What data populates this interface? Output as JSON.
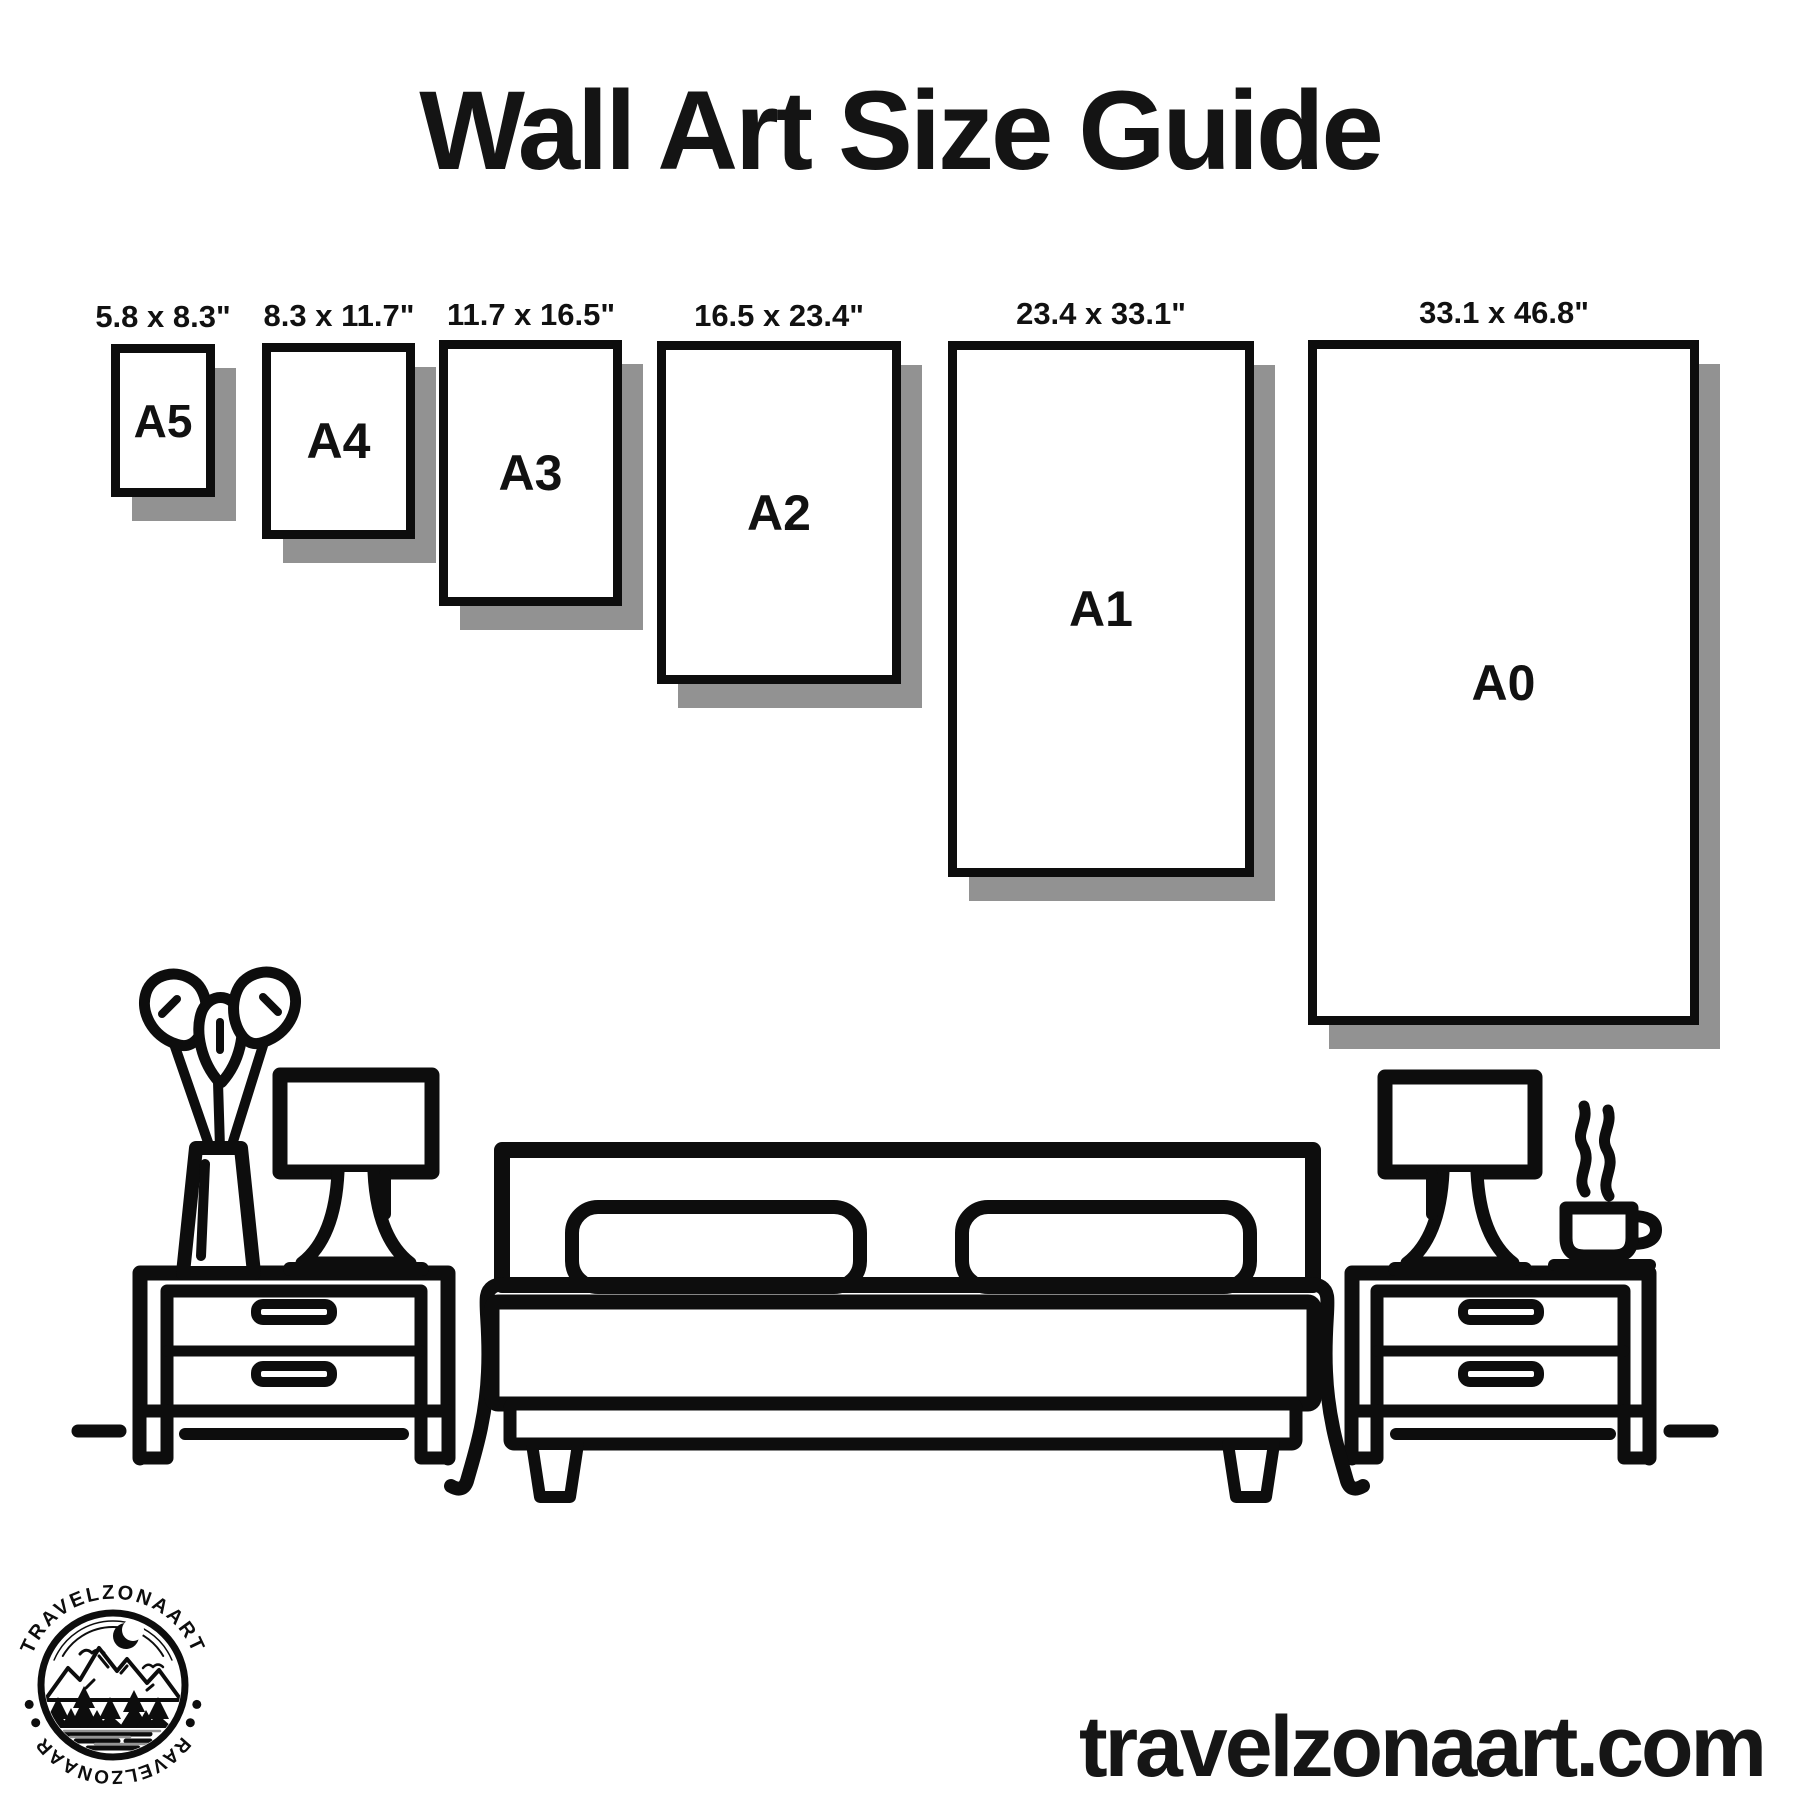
{
  "title": "Wall Art Size Guide",
  "website": "travelzonaart.com",
  "logo": {
    "brand_top": "TRAVELZONAART",
    "brand_bottom": "TRAVELZONAART"
  },
  "sizes": [
    {
      "code": "A5",
      "dimensions": "5.8 x 8.3\""
    },
    {
      "code": "A4",
      "dimensions": "8.3 x 11.7\""
    },
    {
      "code": "A3",
      "dimensions": "11.7 x 16.5\""
    },
    {
      "code": "A2",
      "dimensions": "16.5 x 23.4\""
    },
    {
      "code": "A1",
      "dimensions": "23.4 x 33.1\""
    },
    {
      "code": "A0",
      "dimensions": "33.1 x 46.8\""
    }
  ],
  "colors": {
    "ink": "#0d0d0d",
    "shadow": "#929292",
    "background": "#ffffff"
  },
  "scene_icons": [
    "plant-icon",
    "lamp-icon",
    "bed-icon",
    "pillow",
    "nightstand-icon",
    "coffee-cup-icon",
    "steam-icon",
    "floor-line",
    "logo-badge",
    "moon-icon",
    "mountains-icon",
    "trees-icon",
    "birds-icon"
  ]
}
